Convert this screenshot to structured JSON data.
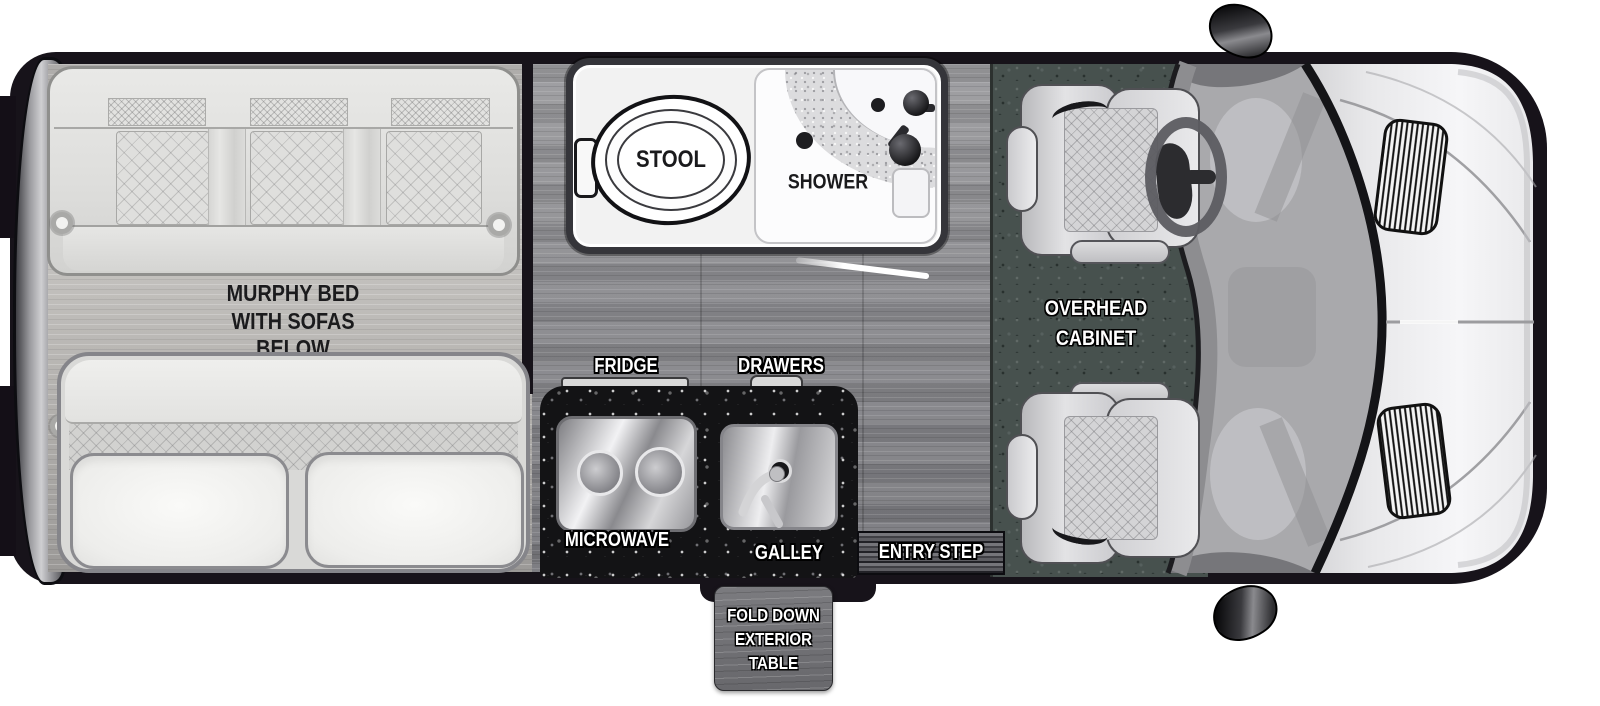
{
  "diagram_type": "rv-floorplan-top-view",
  "labels": {
    "murphy": {
      "l1": "MURPHY BED",
      "l2": "WITH SOFAS",
      "l3": "BELOW"
    },
    "bathroom": {
      "stool": "STOOL",
      "shower": "SHOWER"
    },
    "kitchen": {
      "fridge": "FRIDGE",
      "drawers": "DRAWERS",
      "microwave": "MICROWAVE",
      "galley": "GALLEY",
      "entry_step": "ENTRY STEP"
    },
    "cab": {
      "l1": "OVERHEAD",
      "l2": "CABINET"
    },
    "exterior_table": {
      "l1": "FOLD DOWN",
      "l2": "EXTERIOR",
      "l3": "TABLE"
    }
  },
  "colors": {
    "van_body": "#17131a",
    "floor_wood_mid": "#8f8f92",
    "floor_wood_light": "#bcbab7",
    "cab_carpet": "#47514e",
    "counter_granite": "#131315",
    "hood_light": "#e8e8ea",
    "label_white": "#ffffff",
    "label_black": "#1a1a1c"
  }
}
